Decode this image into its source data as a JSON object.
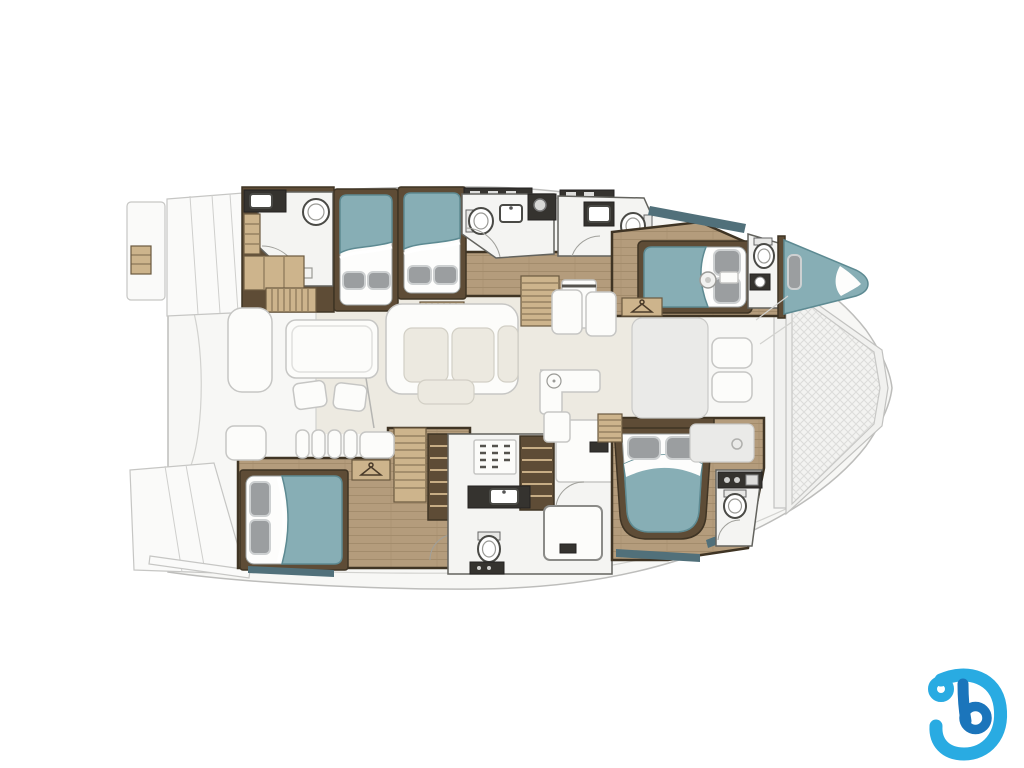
{
  "page": {
    "background": "#ffffff"
  },
  "floorplan": {
    "title": "Catamaran yacht deck and cabin floor plan, bow to the right",
    "vessel_type": "sailing catamaran",
    "orientation": {
      "bow": "right",
      "stern": "left"
    },
    "features": {
      "double_berths": 6,
      "heads_bathrooms": 6,
      "salon_lounge": true,
      "galley": true,
      "aft_cockpit_dining": true,
      "bow_trampoline": true,
      "swim_platforms": 2,
      "stairways": 4,
      "wardrobes": 2
    },
    "rooms": [
      {
        "label": "Port aft head with shower"
      },
      {
        "label": "Port aft twin berths"
      },
      {
        "label": "Port mid head"
      },
      {
        "label": "Port forward head"
      },
      {
        "label": "Port forward double berth"
      },
      {
        "label": "Port bow berth"
      },
      {
        "label": "Starboard aft double berth"
      },
      {
        "label": "Starboard mid head with shower"
      },
      {
        "label": "Starboard aft-facing double berth"
      },
      {
        "label": "Starboard forward head"
      },
      {
        "label": "Salon with L-sofa and galley"
      },
      {
        "label": "Aft cockpit with table and chairs"
      },
      {
        "label": "Bow trampoline"
      }
    ]
  },
  "logo": {
    "glyph": "stylized letter b",
    "position": "bottom-right"
  },
  "colors": {
    "hull_fill": "#f7f7f5",
    "hull_stroke": "#bdbdbb",
    "salon_floor": "#edeae1",
    "wood_floor": "#b49c7c",
    "wood_floor_line": "#a38c6c",
    "wood_frame": "#5e4c36",
    "wood_frame_dark": "#3f3424",
    "wood_shelf": "#cdb48c",
    "wood_shelf_edge": "#6b5940",
    "bath_fill": "#f4f4f2",
    "bath_stroke": "#63635e",
    "dark_counter": "#35332f",
    "bed_teal": "#87aeb5",
    "bed_teal_dark": "#5d8a92",
    "pillow": "#9b9ea0",
    "pillow_hi": "#cdd0d1",
    "window_teal": "#51707a",
    "logo_light": "#29abe2",
    "logo_dark": "#1b75bb"
  }
}
